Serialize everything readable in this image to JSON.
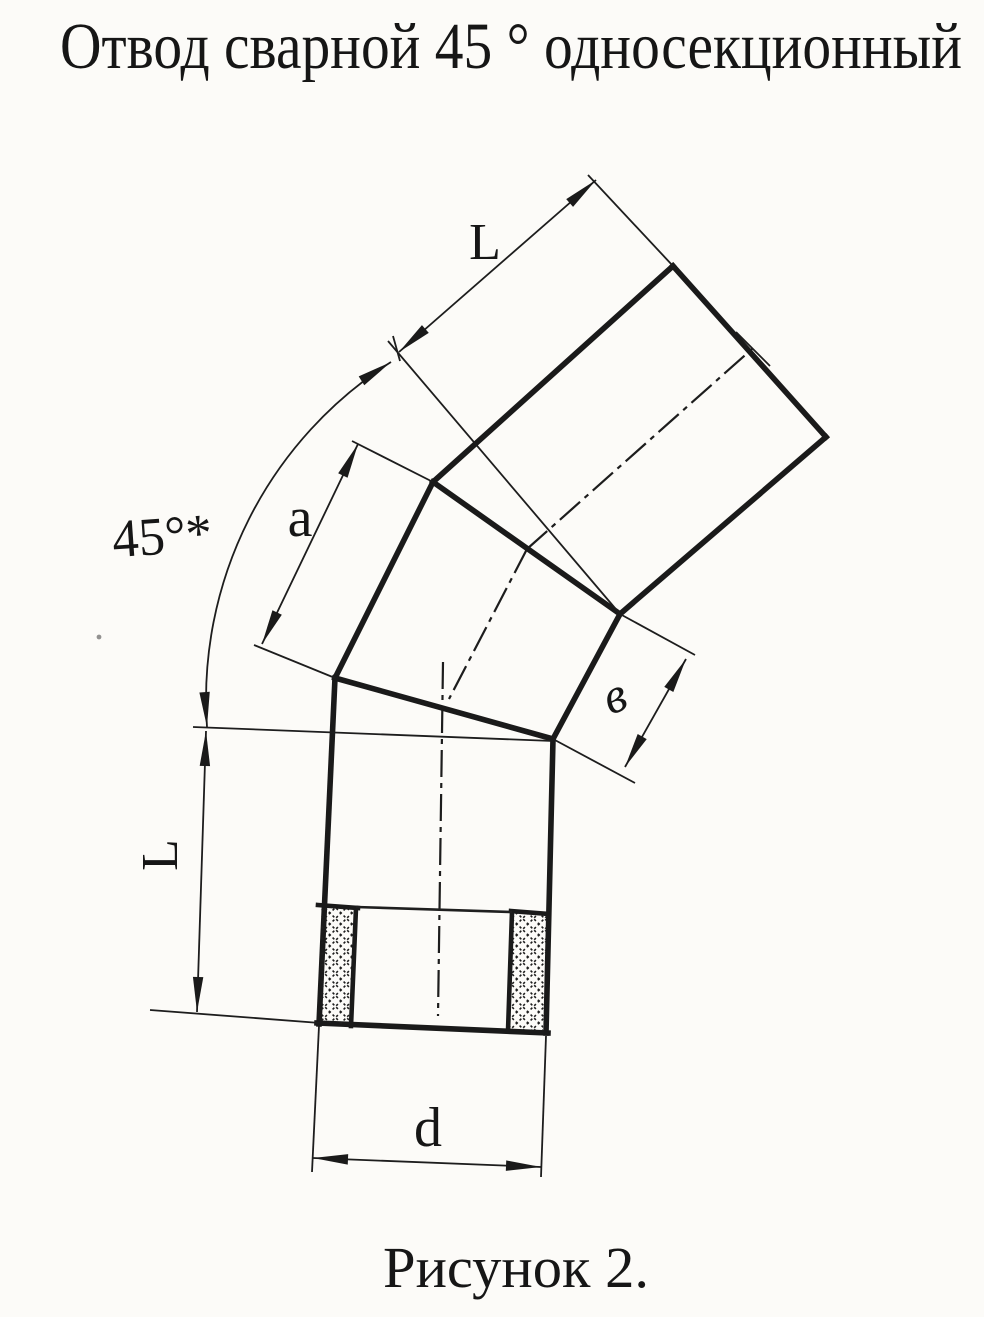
{
  "page": {
    "title": "Отвод сварной 45 ° односекционный",
    "caption": "Рисунок 2."
  },
  "drawing": {
    "labels": {
      "top_pipe_length": "L",
      "bend_angle": "45°*",
      "section_short_side": "a",
      "section_long_side": "в",
      "bottom_pipe_length": "L",
      "outer_diameter": "d"
    },
    "colors": {
      "ink": "#1a1a1a",
      "paper": "#fcfbf8"
    }
  }
}
